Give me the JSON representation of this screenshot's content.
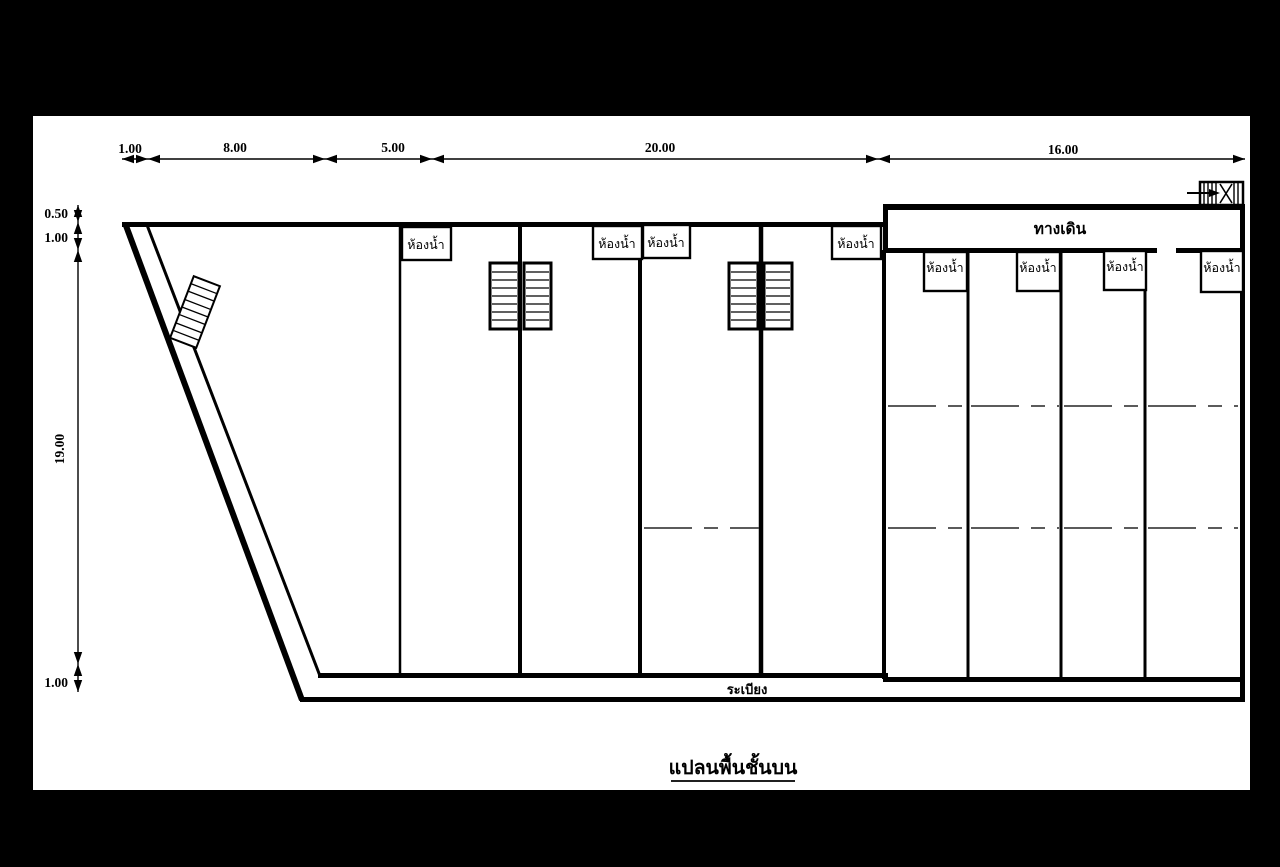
{
  "colors": {
    "background": "#000000",
    "paper": "#ffffff",
    "ink": "#000000"
  },
  "title": "แปลนพื้นชั้นบน",
  "dimensions": {
    "top": [
      "1.00",
      "8.00",
      "5.00",
      "20.00",
      "16.00"
    ],
    "left": [
      "0.50",
      "1.00",
      "19.00",
      "1.00"
    ]
  },
  "corridor_label": "ทางเดิน",
  "balcony_label": "ระเบียง",
  "bathrooms": {
    "top_row": [
      "ห้องน้ำ",
      "ห้องน้ำ",
      "ห้องน้ำ",
      "ห้องน้ำ"
    ],
    "right_row": [
      "ห้องน้ำ",
      "ห้องน้ำ",
      "ห้องน้ำ",
      "ห้องน้ำ"
    ]
  }
}
